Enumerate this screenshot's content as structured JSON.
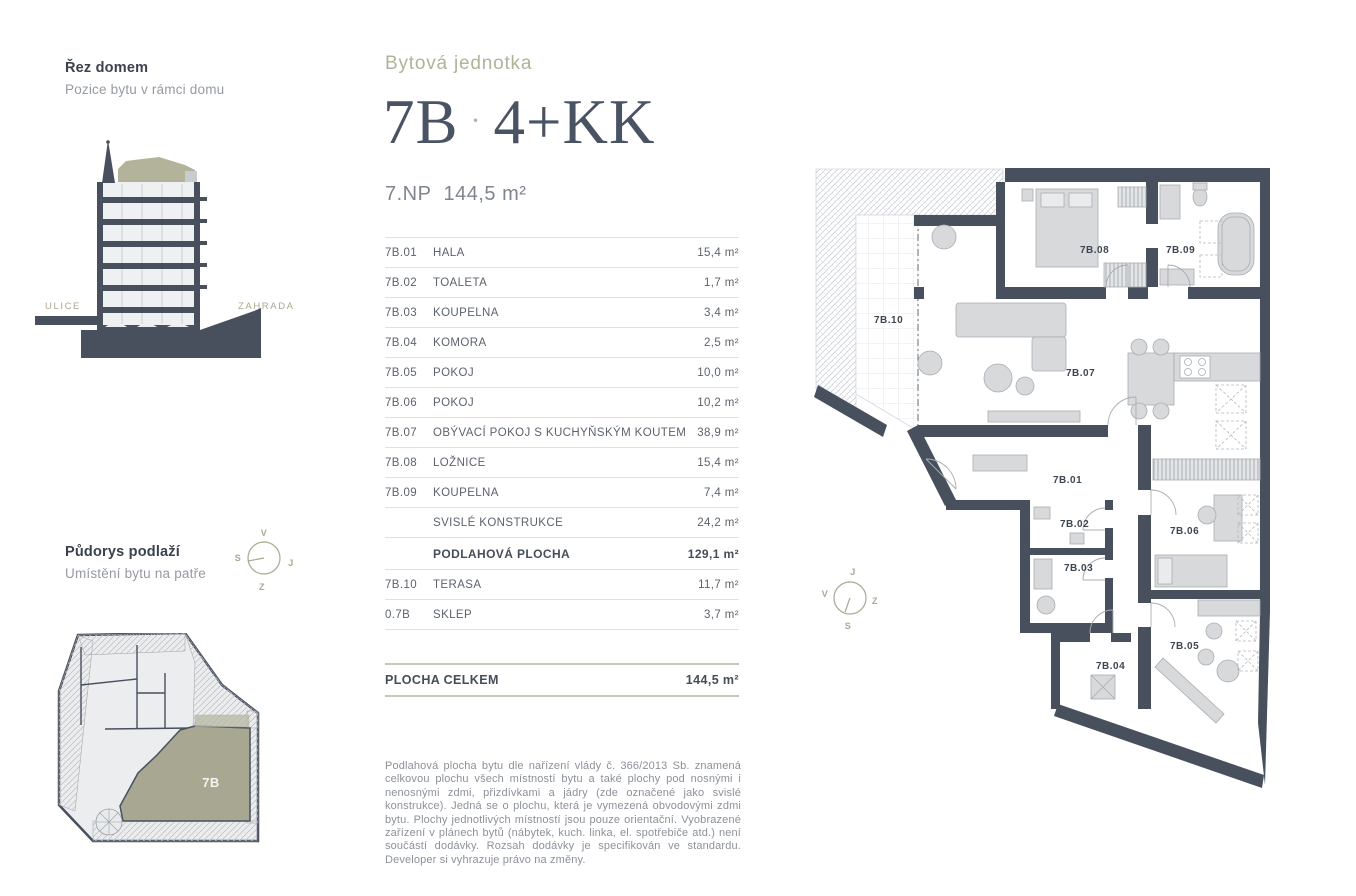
{
  "colors": {
    "wall": "#47505c",
    "olive_fill": "#a8a791",
    "olive_text": "#b2b199",
    "title_text": "#4a5363",
    "furniture": "#d7d9db"
  },
  "section_panel": {
    "title": "Řez domem",
    "subtitle": "Pozice bytu v rámci domu",
    "street_label": "ULICE",
    "garden_label": "ZAHRADA"
  },
  "floor_panel": {
    "title": "Půdorys podlaží",
    "subtitle": "Umístění bytu na patře",
    "unit_label": "7B",
    "compass": {
      "top": "V",
      "left": "S",
      "right": "J",
      "bottom": "Z"
    }
  },
  "header": {
    "eyebrow": "Bytová jednotka",
    "unit_id": "7B",
    "separator": "·",
    "layout_type": "4+KK",
    "floor_label": "7.NP",
    "area_label": "144,5 m²"
  },
  "rooms_table": {
    "rows": [
      {
        "code": "7B.01",
        "name": "HALA",
        "area": "15,4 m²",
        "bold": false
      },
      {
        "code": "7B.02",
        "name": "TOALETA",
        "area": "1,7 m²",
        "bold": false
      },
      {
        "code": "7B.03",
        "name": "KOUPELNA",
        "area": "3,4 m²",
        "bold": false
      },
      {
        "code": "7B.04",
        "name": "KOMORA",
        "area": "2,5 m²",
        "bold": false
      },
      {
        "code": "7B.05",
        "name": "POKOJ",
        "area": "10,0 m²",
        "bold": false
      },
      {
        "code": "7B.06",
        "name": "POKOJ",
        "area": "10,2 m²",
        "bold": false
      },
      {
        "code": "7B.07",
        "name": "OBÝVACÍ POKOJ S KUCHYŇSKÝM KOUTEM",
        "area": "38,9 m²",
        "bold": false
      },
      {
        "code": "7B.08",
        "name": "LOŽNICE",
        "area": "15,4 m²",
        "bold": false
      },
      {
        "code": "7B.09",
        "name": "KOUPELNA",
        "area": "7,4 m²",
        "bold": false
      },
      {
        "code": "",
        "name": "SVISLÉ KONSTRUKCE",
        "area": "24,2 m²",
        "bold": false
      },
      {
        "code": "",
        "name": "PODLAHOVÁ PLOCHA",
        "area": "129,1 m²",
        "bold": true
      },
      {
        "code": "7B.10",
        "name": "TERASA",
        "area": "11,7 m²",
        "bold": false
      },
      {
        "code": "0.7B",
        "name": "SKLEP",
        "area": "3,7 m²",
        "bold": false
      }
    ],
    "total_label": "PLOCHA CELKEM",
    "total_area": "144,5 m²"
  },
  "main_plan": {
    "compass": {
      "top": "J",
      "left": "V",
      "right": "Z",
      "bottom": "S"
    },
    "labels": {
      "terrace": "7B.10",
      "bedroom": "7B.08",
      "bathroom2": "7B.09",
      "living": "7B.07",
      "hall": "7B.01",
      "toilet": "7B.02",
      "bathroom1": "7B.03",
      "room2": "7B.06",
      "room1": "7B.05",
      "storage": "7B.04"
    }
  },
  "disclaimer": "Podlahová plocha bytu dle nařízení vlády č. 366/2013 Sb. znamená celkovou plochu všech místností bytu a také plochy pod nosnými i nenosnými zdmi, přizdívkami a jádry (zde označené jako svislé konstrukce). Jedná se o plochu, která je vymezená obvodovými zdmi bytu. Plochy jednotlivých místností jsou pouze orientační. Vyobrazené zařízení v plánech bytů (nábytek, kuch. linka, el. spotřebiče atd.) není součástí dodávky. Rozsah dodávky je specifikován ve standardu. Developer si vyhrazuje právo na změny."
}
